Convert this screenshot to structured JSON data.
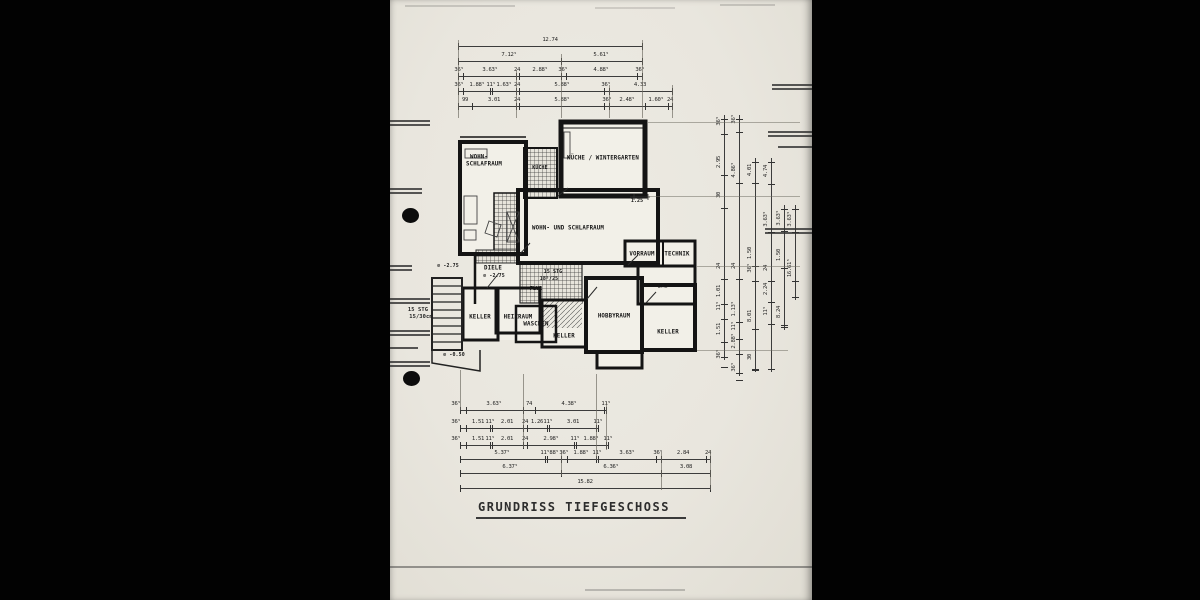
{
  "title": "GRUNDRISS TIEFGESCHOSS",
  "plan": {
    "labels": [
      {
        "t": "WOHN-",
        "x": 89,
        "y": 157
      },
      {
        "t": "SCHLAFRAUM",
        "x": 94,
        "y": 164
      },
      {
        "t": "KÜCHE",
        "x": 150,
        "y": 168,
        "s": "xs"
      },
      {
        "t": "KÜCHE / WINTERGARTEN",
        "x": 213,
        "y": 158
      },
      {
        "t": "WOHN- UND SCHLAFRAUM",
        "x": 178,
        "y": 228
      },
      {
        "t": "VORRAUM",
        "x": 252,
        "y": 254
      },
      {
        "t": "TECHNIK",
        "x": 287,
        "y": 254
      },
      {
        "t": "BAD",
        "x": 273,
        "y": 286
      },
      {
        "t": "KELLER",
        "x": 278,
        "y": 332
      },
      {
        "t": "HOBBYRAUM",
        "x": 224,
        "y": 316
      },
      {
        "t": "KELLER",
        "x": 174,
        "y": 336
      },
      {
        "t": "WASCHEN",
        "x": 146,
        "y": 324
      },
      {
        "t": "HEIZRAUM",
        "x": 128,
        "y": 317
      },
      {
        "t": "KELLER",
        "x": 90,
        "y": 317
      },
      {
        "t": "DIELE",
        "x": 103,
        "y": 268
      },
      {
        "t": "⊘ -2.75",
        "x": 104,
        "y": 276,
        "s": "xs"
      },
      {
        "t": "⊘ -2.75",
        "x": 58,
        "y": 266,
        "s": "xs"
      },
      {
        "t": "FLUR",
        "x": 146,
        "y": 289,
        "s": "xs"
      },
      {
        "t": "15 STG",
        "x": 163,
        "y": 272,
        "s": "xs"
      },
      {
        "t": "18⁵/25",
        "x": 159,
        "y": 279,
        "s": "xs"
      },
      {
        "t": "⊘ -0.50",
        "x": 64,
        "y": 355,
        "s": "xs"
      },
      {
        "t": "15 STG",
        "x": 28,
        "y": 310,
        "s": "sm"
      },
      {
        "t": "15/30cm",
        "x": 31,
        "y": 317,
        "s": "sm"
      },
      {
        "t": "1.25",
        "x": 247,
        "y": 201,
        "s": "xs"
      }
    ]
  },
  "dims": {
    "h_rows": [
      {
        "y": 46,
        "x1": 68,
        "x2": 252,
        "ticks": [
          68,
          252
        ],
        "labels": [
          {
            "t": "12.74",
            "x": 160
          }
        ]
      },
      {
        "y": 61,
        "x1": 68,
        "x2": 252,
        "ticks": [
          68,
          171,
          252
        ],
        "labels": [
          {
            "t": "7.12⁵",
            "x": 119
          },
          {
            "t": "5.61⁵",
            "x": 211
          }
        ]
      },
      {
        "y": 76,
        "x1": 68,
        "x2": 252,
        "ticks": [
          68,
          73,
          126,
          129,
          171,
          176,
          247,
          252
        ],
        "labels": [
          {
            "t": "36⁵",
            "x": 69
          },
          {
            "t": "3.63⁵",
            "x": 100
          },
          {
            "t": "24",
            "x": 127
          },
          {
            "t": "2.88⁵",
            "x": 150
          },
          {
            "t": "36⁵",
            "x": 173
          },
          {
            "t": "4.88⁵",
            "x": 211
          },
          {
            "t": "36⁵",
            "x": 250
          }
        ]
      },
      {
        "y": 91,
        "x1": 68,
        "x2": 282,
        "ticks": [
          68,
          73,
          100,
          102,
          126,
          129,
          214,
          219,
          282
        ],
        "labels": [
          {
            "t": "36⁵",
            "x": 69
          },
          {
            "t": "1.88⁵",
            "x": 87
          },
          {
            "t": "11⁵",
            "x": 101
          },
          {
            "t": "1.63⁵",
            "x": 114
          },
          {
            "t": "24",
            "x": 127
          },
          {
            "t": "5.88⁵",
            "x": 172
          },
          {
            "t": "36⁵",
            "x": 216
          },
          {
            "t": "4.33",
            "x": 250
          }
        ]
      },
      {
        "y": 106,
        "x1": 68,
        "x2": 282,
        "ticks": [
          68,
          82,
          126,
          129,
          214,
          219,
          255,
          278,
          282
        ],
        "labels": [
          {
            "t": "99",
            "x": 75
          },
          {
            "t": "3.01",
            "x": 104
          },
          {
            "t": "24",
            "x": 127
          },
          {
            "t": "5.88⁵",
            "x": 172
          },
          {
            "t": "36⁵",
            "x": 217
          },
          {
            "t": "2.48⁵",
            "x": 237
          },
          {
            "t": "1.60⁵",
            "x": 266
          },
          {
            "t": "24",
            "x": 280
          }
        ]
      },
      {
        "y": 410,
        "x1": 70,
        "x2": 216,
        "ticks": [
          70,
          76,
          133,
          145,
          214,
          216
        ],
        "labels": [
          {
            "t": "36⁵",
            "x": 66
          },
          {
            "t": "3.63⁵",
            "x": 104
          },
          {
            "t": "74",
            "x": 139
          },
          {
            "t": "4.38⁵",
            "x": 179
          },
          {
            "t": "11⁵",
            "x": 216
          }
        ]
      },
      {
        "y": 428,
        "x1": 70,
        "x2": 208,
        "ticks": [
          70,
          76,
          100,
          102,
          133,
          137,
          157,
          159,
          206,
          208
        ],
        "labels": [
          {
            "t": "36⁵",
            "x": 66
          },
          {
            "t": "1.51",
            "x": 88
          },
          {
            "t": "11⁵",
            "x": 100
          },
          {
            "t": "2.01",
            "x": 117
          },
          {
            "t": "24",
            "x": 135
          },
          {
            "t": "1.26",
            "x": 147
          },
          {
            "t": "11⁵",
            "x": 158
          },
          {
            "t": "3.01",
            "x": 183
          },
          {
            "t": "11⁵",
            "x": 208
          }
        ]
      },
      {
        "y": 445,
        "x1": 70,
        "x2": 218,
        "ticks": [
          70,
          76,
          100,
          102,
          133,
          137,
          184,
          186,
          216,
          218
        ],
        "labels": [
          {
            "t": "36⁵",
            "x": 66
          },
          {
            "t": "1.51",
            "x": 88
          },
          {
            "t": "11⁵",
            "x": 100
          },
          {
            "t": "2.01",
            "x": 117
          },
          {
            "t": "24",
            "x": 135
          },
          {
            "t": "2.98⁵",
            "x": 161
          },
          {
            "t": "11⁵",
            "x": 185
          },
          {
            "t": "1.88⁵",
            "x": 201
          },
          {
            "t": "11⁵",
            "x": 218
          }
        ]
      },
      {
        "y": 459,
        "x1": 70,
        "x2": 320,
        "ticks": [
          70,
          155,
          157,
          171,
          177,
          206,
          208,
          266,
          271,
          316,
          320
        ],
        "labels": [
          {
            "t": "5.37⁵",
            "x": 112
          },
          {
            "t": "11⁵",
            "x": 155
          },
          {
            "t": "88⁵",
            "x": 164
          },
          {
            "t": "36⁵",
            "x": 174
          },
          {
            "t": "1.88⁵",
            "x": 191
          },
          {
            "t": "11⁵",
            "x": 207
          },
          {
            "t": "3.63⁵",
            "x": 237
          },
          {
            "t": "36⁵",
            "x": 268
          },
          {
            "t": "2.84",
            "x": 293
          },
          {
            "t": "24",
            "x": 318
          }
        ]
      },
      {
        "y": 473,
        "x1": 70,
        "x2": 320,
        "ticks": [
          70,
          171,
          271,
          320
        ],
        "labels": [
          {
            "t": "6.37⁵",
            "x": 120
          },
          {
            "t": "6.36⁵",
            "x": 221
          },
          {
            "t": "3.08",
            "x": 296
          }
        ]
      },
      {
        "y": 488,
        "x1": 70,
        "x2": 320,
        "ticks": [
          70,
          320
        ],
        "labels": [
          {
            "t": "15.82",
            "x": 195
          }
        ]
      }
    ],
    "v_cols": [
      {
        "x": 334,
        "y1": 115,
        "y2": 360,
        "labels": [
          {
            "t": "36⁵",
            "y": 121
          },
          {
            "t": "2.95",
            "y": 162
          },
          {
            "t": "30",
            "y": 195
          },
          {
            "t": "24",
            "y": 266
          },
          {
            "t": "1.01",
            "y": 291
          },
          {
            "t": "11⁵",
            "y": 306
          },
          {
            "t": "1.51",
            "y": 329
          },
          {
            "t": "36⁵",
            "y": 354
          }
        ]
      },
      {
        "x": 349,
        "y1": 115,
        "y2": 376,
        "labels": [
          {
            "t": "36⁵",
            "y": 119
          },
          {
            "t": "4.86⁵",
            "y": 170
          },
          {
            "t": "24",
            "y": 266
          },
          {
            "t": "1.13⁵",
            "y": 309
          },
          {
            "t": "11⁵",
            "y": 326
          },
          {
            "t": "2.88⁵",
            "y": 341
          },
          {
            "t": "36⁵",
            "y": 367
          }
        ]
      },
      {
        "x": 365,
        "y1": 158,
        "y2": 372,
        "labels": [
          {
            "t": "4.01",
            "y": 170
          },
          {
            "t": "1.50",
            "y": 253
          },
          {
            "t": "36⁵",
            "y": 268
          },
          {
            "t": "8.01",
            "y": 316
          },
          {
            "t": "30",
            "y": 357
          }
        ]
      },
      {
        "x": 381,
        "y1": 158,
        "y2": 372,
        "labels": [
          {
            "t": "4.74",
            "y": 171
          },
          {
            "t": "3.63⁵",
            "y": 219
          },
          {
            "t": "24",
            "y": 268
          },
          {
            "t": "2.24",
            "y": 289
          },
          {
            "t": "11⁵",
            "y": 311
          }
        ]
      },
      {
        "x": 394,
        "y1": 205,
        "y2": 330,
        "labels": [
          {
            "t": "3.63⁵",
            "y": 218
          },
          {
            "t": "1.50",
            "y": 255
          },
          {
            "t": "8.24",
            "y": 312
          }
        ]
      },
      {
        "x": 405,
        "y1": 205,
        "y2": 300,
        "labels": [
          {
            "t": "3.63⁵",
            "y": 219
          },
          {
            "t": "16.61⁵",
            "y": 268
          }
        ]
      }
    ],
    "guides": [
      {
        "x": 68,
        "y1": 40,
        "y2": 118
      },
      {
        "x": 171,
        "y1": 54,
        "y2": 118
      },
      {
        "x": 252,
        "y1": 40,
        "y2": 118
      },
      {
        "x": 126,
        "y1": 70,
        "y2": 118
      },
      {
        "x": 219,
        "y1": 85,
        "y2": 118
      },
      {
        "x": 282,
        "y1": 85,
        "y2": 118
      },
      {
        "x": 70,
        "y1": 370,
        "y2": 410
      },
      {
        "x": 133,
        "y1": 374,
        "y2": 448
      },
      {
        "x": 206,
        "y1": 374,
        "y2": 460
      },
      {
        "x": 216,
        "y1": 402,
        "y2": 450
      },
      {
        "x": 271,
        "y1": 452,
        "y2": 490
      },
      {
        "x": 320,
        "y1": 450,
        "y2": 490
      },
      {
        "x": 171,
        "y1": 452,
        "y2": 476
      }
    ],
    "h_guides": [
      {
        "y": 122,
        "x1": 258,
        "x2": 410
      },
      {
        "y": 196,
        "x1": 258,
        "x2": 410
      },
      {
        "y": 266,
        "x1": 307,
        "x2": 410
      },
      {
        "y": 350,
        "x1": 307,
        "x2": 398
      }
    ]
  },
  "edge_lines": [
    {
      "x": 0,
      "y": 120,
      "w": 40
    },
    {
      "x": 0,
      "y": 124,
      "w": 40
    },
    {
      "x": 0,
      "y": 188,
      "w": 32
    },
    {
      "x": 0,
      "y": 192,
      "w": 32
    },
    {
      "x": 0,
      "y": 265,
      "w": 22
    },
    {
      "x": 0,
      "y": 269,
      "w": 22
    },
    {
      "x": 0,
      "y": 298,
      "w": 40
    },
    {
      "x": 0,
      "y": 302,
      "w": 40
    },
    {
      "x": 0,
      "y": 330,
      "w": 40
    },
    {
      "x": 0,
      "y": 334,
      "w": 40
    },
    {
      "x": 0,
      "y": 347,
      "w": 28
    },
    {
      "x": 0,
      "y": 361,
      "w": 40
    },
    {
      "x": 0,
      "y": 365,
      "w": 40
    },
    {
      "x": 382,
      "y": 84,
      "w": 40
    },
    {
      "x": 382,
      "y": 88,
      "w": 40
    },
    {
      "x": 378,
      "y": 131,
      "w": 44
    },
    {
      "x": 378,
      "y": 135,
      "w": 44
    },
    {
      "x": 388,
      "y": 146,
      "w": 34
    },
    {
      "x": 375,
      "y": 228,
      "w": 47
    },
    {
      "x": 375,
      "y": 232,
      "w": 47
    },
    {
      "x": 0,
      "y": 566,
      "w": 422,
      "op": 0.45
    },
    {
      "x": 15,
      "y": 5,
      "w": 110,
      "op": 0.18
    },
    {
      "x": 205,
      "y": 7,
      "w": 80,
      "op": 0.15
    },
    {
      "x": 330,
      "y": 4,
      "w": 55,
      "op": 0.18
    },
    {
      "x": 195,
      "y": 589,
      "w": 100,
      "op": 0.25
    }
  ]
}
